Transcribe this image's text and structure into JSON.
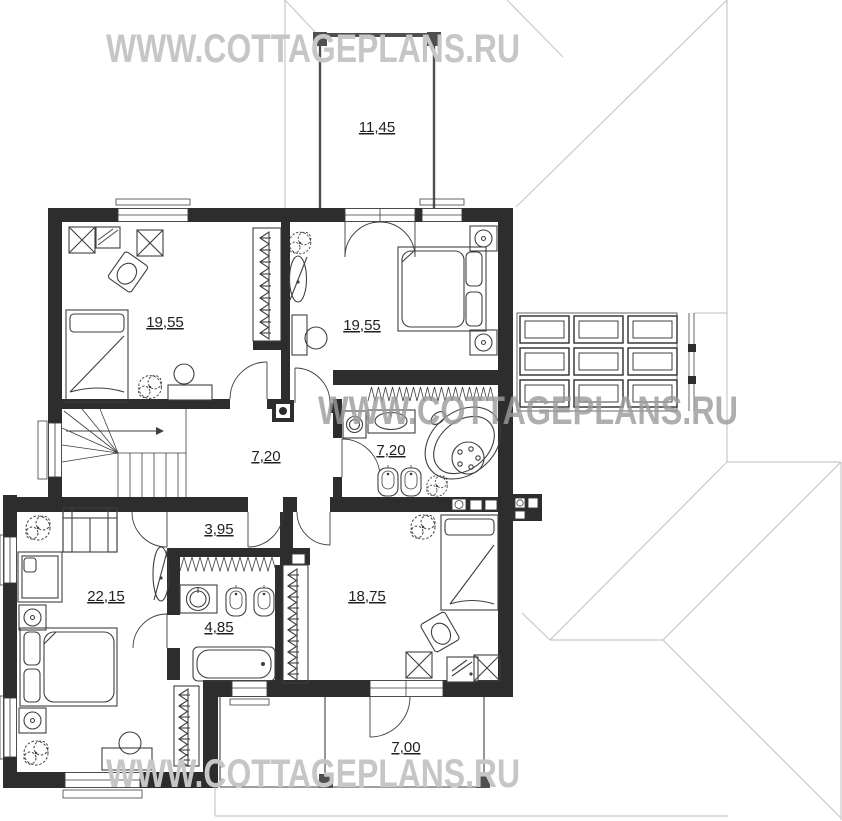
{
  "watermark": {
    "text": "WWW.COTTAGEPLANS.RU"
  },
  "rooms": [
    {
      "name": "balcony",
      "area": "11,45"
    },
    {
      "name": "bedroom-top-left",
      "area": "19,55"
    },
    {
      "name": "bedroom-top-right",
      "area": "19,55"
    },
    {
      "name": "stair-hall",
      "area": "7,20"
    },
    {
      "name": "bathroom-main",
      "area": "7,20"
    },
    {
      "name": "corridor",
      "area": "3,95"
    },
    {
      "name": "bedroom-master",
      "area": "22,15"
    },
    {
      "name": "bathroom-ensuite",
      "area": "4,85"
    },
    {
      "name": "bedroom-right",
      "area": "18,75"
    },
    {
      "name": "terrace",
      "area": "7,00"
    }
  ],
  "colors": {
    "wall": "#2d2d2d",
    "post": "#4f4f4f",
    "furn": "#3f3f3f",
    "roof": "#c9c9c9",
    "wm": "#c6c6c6",
    "wm-mid": "#9b9b9b",
    "label": "#1f1f1f",
    "win": "#3a3a3a"
  }
}
